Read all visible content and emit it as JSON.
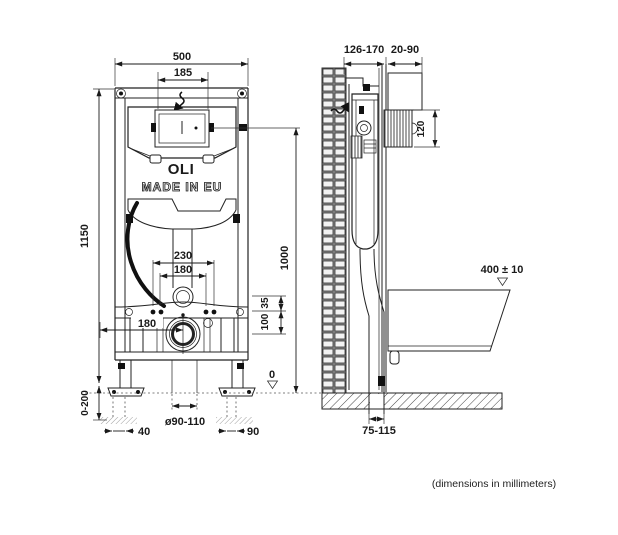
{
  "front": {
    "brand": "OLI",
    "origin_label": "MADE IN EU",
    "dims": {
      "total_width": "500",
      "panel_width": "185",
      "total_height": "1150",
      "leg_adjust_range": "0-200",
      "bolt_spacing_outer": "230",
      "bolt_spacing_inner": "180",
      "inlet_to_bar": "35",
      "bar_to_drain": "100",
      "drain_offset": "180",
      "button_height": "1000",
      "floor_datum": "0",
      "drain_diameter": "ø90-110",
      "foot_slot_left": "40",
      "foot_slot_right": "90"
    }
  },
  "side": {
    "dims": {
      "frame_depth": "126-170",
      "wall_finish": "20-90",
      "plate_height": "120",
      "bowl_height": "400 ± 10",
      "outlet_offset": "75-115"
    }
  },
  "footnote": "(dimensions in millimeters)"
}
